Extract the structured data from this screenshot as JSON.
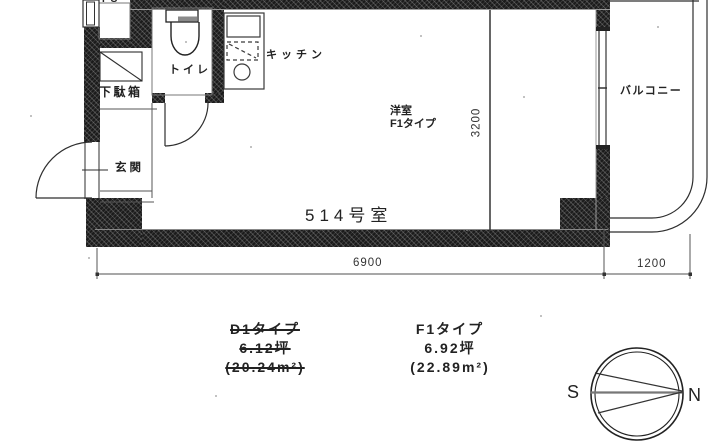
{
  "plan": {
    "ps": "PS",
    "toilet": "トイレ",
    "kitchen": "キッチン",
    "shoe_cabinet": "下駄箱",
    "entrance": "玄関",
    "room": "洋室",
    "room_type": "F1タイプ",
    "balcony": "バルコニー",
    "room_number": "514号室",
    "dim_width": "6900",
    "dim_balcony": "1200",
    "dim_depth": "3200"
  },
  "legend": {
    "old": {
      "type": "D1タイプ",
      "tsubo": "6.12坪",
      "area": "(20.24m²)"
    },
    "new": {
      "type": "F1タイプ",
      "tsubo": "6.92坪",
      "area": "(22.89m²)"
    }
  },
  "compass": {
    "south": "S",
    "north": "N"
  },
  "colors": {
    "wall": "#1b1b1b",
    "line": "#2e2e2e",
    "dim_line": "#8a8a8a",
    "background": "#ffffff"
  }
}
